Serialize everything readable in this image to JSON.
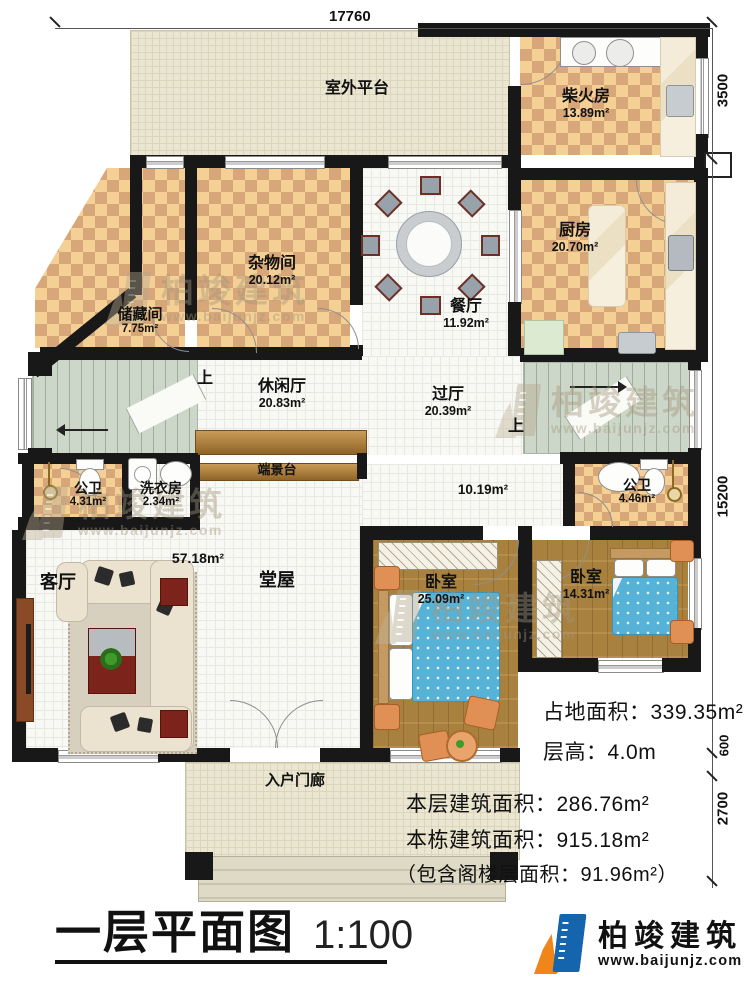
{
  "title": {
    "text": "一层平面图",
    "scale": "1:100"
  },
  "logo": {
    "name": "柏竣建筑",
    "url": "www.baijunjz.com"
  },
  "watermark": {
    "text": "柏竣建筑",
    "url": "www.baijunjz.com"
  },
  "dimensions": {
    "top": "17760",
    "right": [
      "3500",
      "15200",
      "600",
      "2700"
    ]
  },
  "stats": [
    "占地面积：339.35m²",
    "层高：4.0m",
    "本层建筑面积：286.76m²",
    "本栋建筑面积：915.18m²",
    "（包含阁楼层面积：91.96m²）"
  ],
  "stair_up": "上",
  "colors": {
    "logo_blue": "#1465ae",
    "logo_orange": "#f08519"
  },
  "rooms": [
    {
      "id": "platform",
      "name": "室外平台",
      "area": ""
    },
    {
      "id": "firewood",
      "name": "柴火房",
      "area": "13.89m²"
    },
    {
      "id": "kitchen",
      "name": "厨房",
      "area": "20.70m²"
    },
    {
      "id": "sundry",
      "name": "杂物间",
      "area": "20.12m²"
    },
    {
      "id": "storage",
      "name": "储藏间",
      "area": "7.75m²"
    },
    {
      "id": "dining",
      "name": "餐厅",
      "area": "11.92m²"
    },
    {
      "id": "leisure",
      "name": "休闲厅",
      "area": "20.83m²"
    },
    {
      "id": "hall",
      "name": "过厅",
      "area": "20.39m²"
    },
    {
      "id": "corridor",
      "name": "",
      "area": "10.19m²"
    },
    {
      "id": "wc-left",
      "name": "公卫",
      "area": "4.31m²"
    },
    {
      "id": "laundry",
      "name": "洗衣房",
      "area": "2.34m²"
    },
    {
      "id": "console",
      "name": "端景台",
      "area": ""
    },
    {
      "id": "tangwu",
      "name": "堂屋",
      "area": "57.18m²"
    },
    {
      "id": "living",
      "name": "客厅",
      "area": ""
    },
    {
      "id": "bedroom-1",
      "name": "卧室",
      "area": "25.09m²"
    },
    {
      "id": "bedroom-2",
      "name": "卧室",
      "area": "14.31m²"
    },
    {
      "id": "wc-right",
      "name": "公卫",
      "area": "4.46m²"
    },
    {
      "id": "porch",
      "name": "入户门廊",
      "area": ""
    }
  ]
}
